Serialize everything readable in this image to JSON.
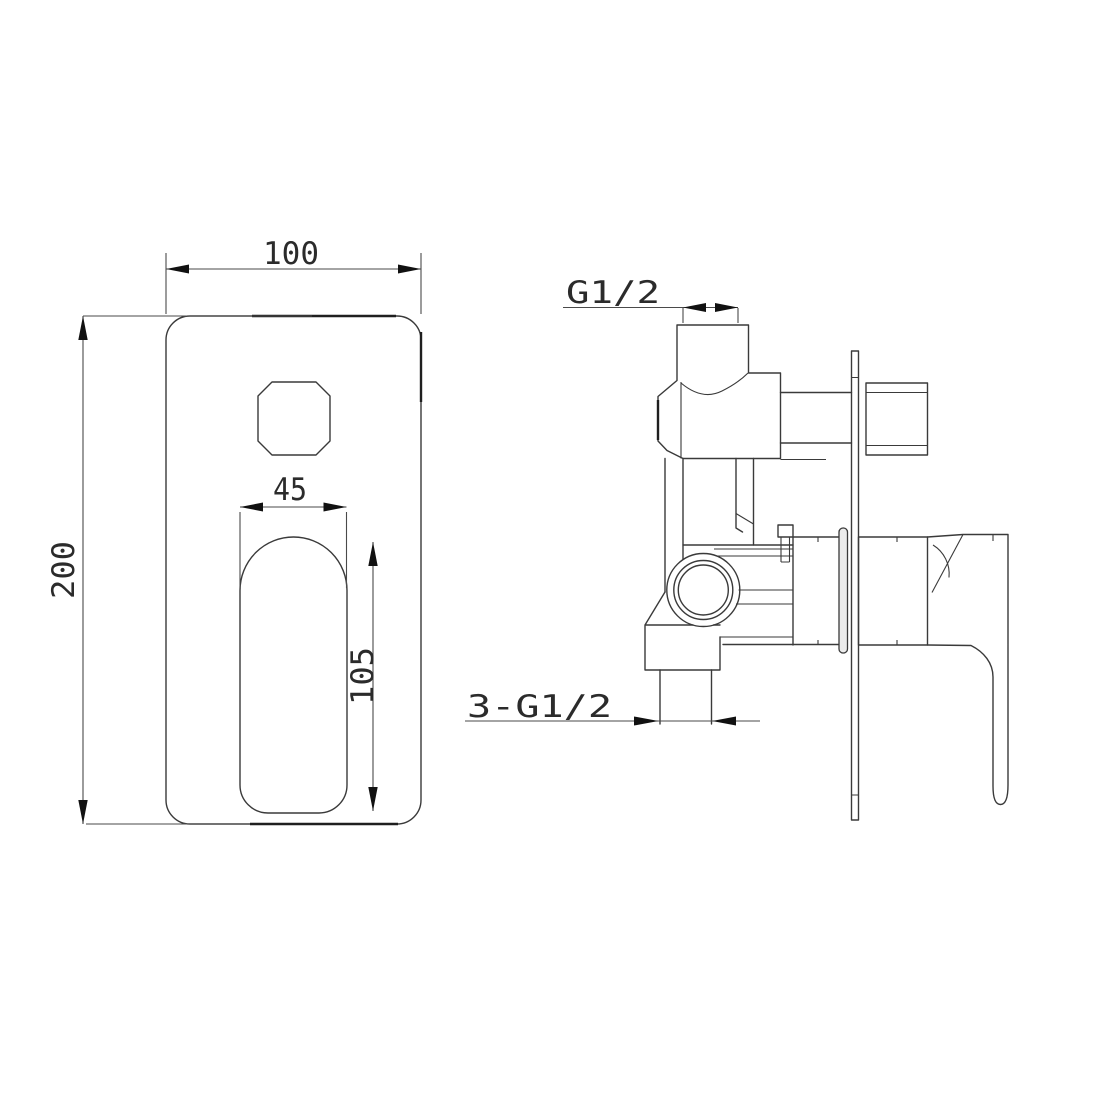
{
  "drawing": {
    "type": "technical-dimension-drawing",
    "subject": "concealed shower mixer valve, front view and side view",
    "background_color": "#ffffff",
    "line_color": "#3a3a3a",
    "text_color": "#2b2b2b"
  },
  "front_view": {
    "dim_width": "100",
    "dim_height": "200",
    "dim_slot_width": "45",
    "dim_slot_height": "105"
  },
  "side_view": {
    "label_top_port": "G1/2",
    "label_bottom_ports": "3-G1/2"
  }
}
